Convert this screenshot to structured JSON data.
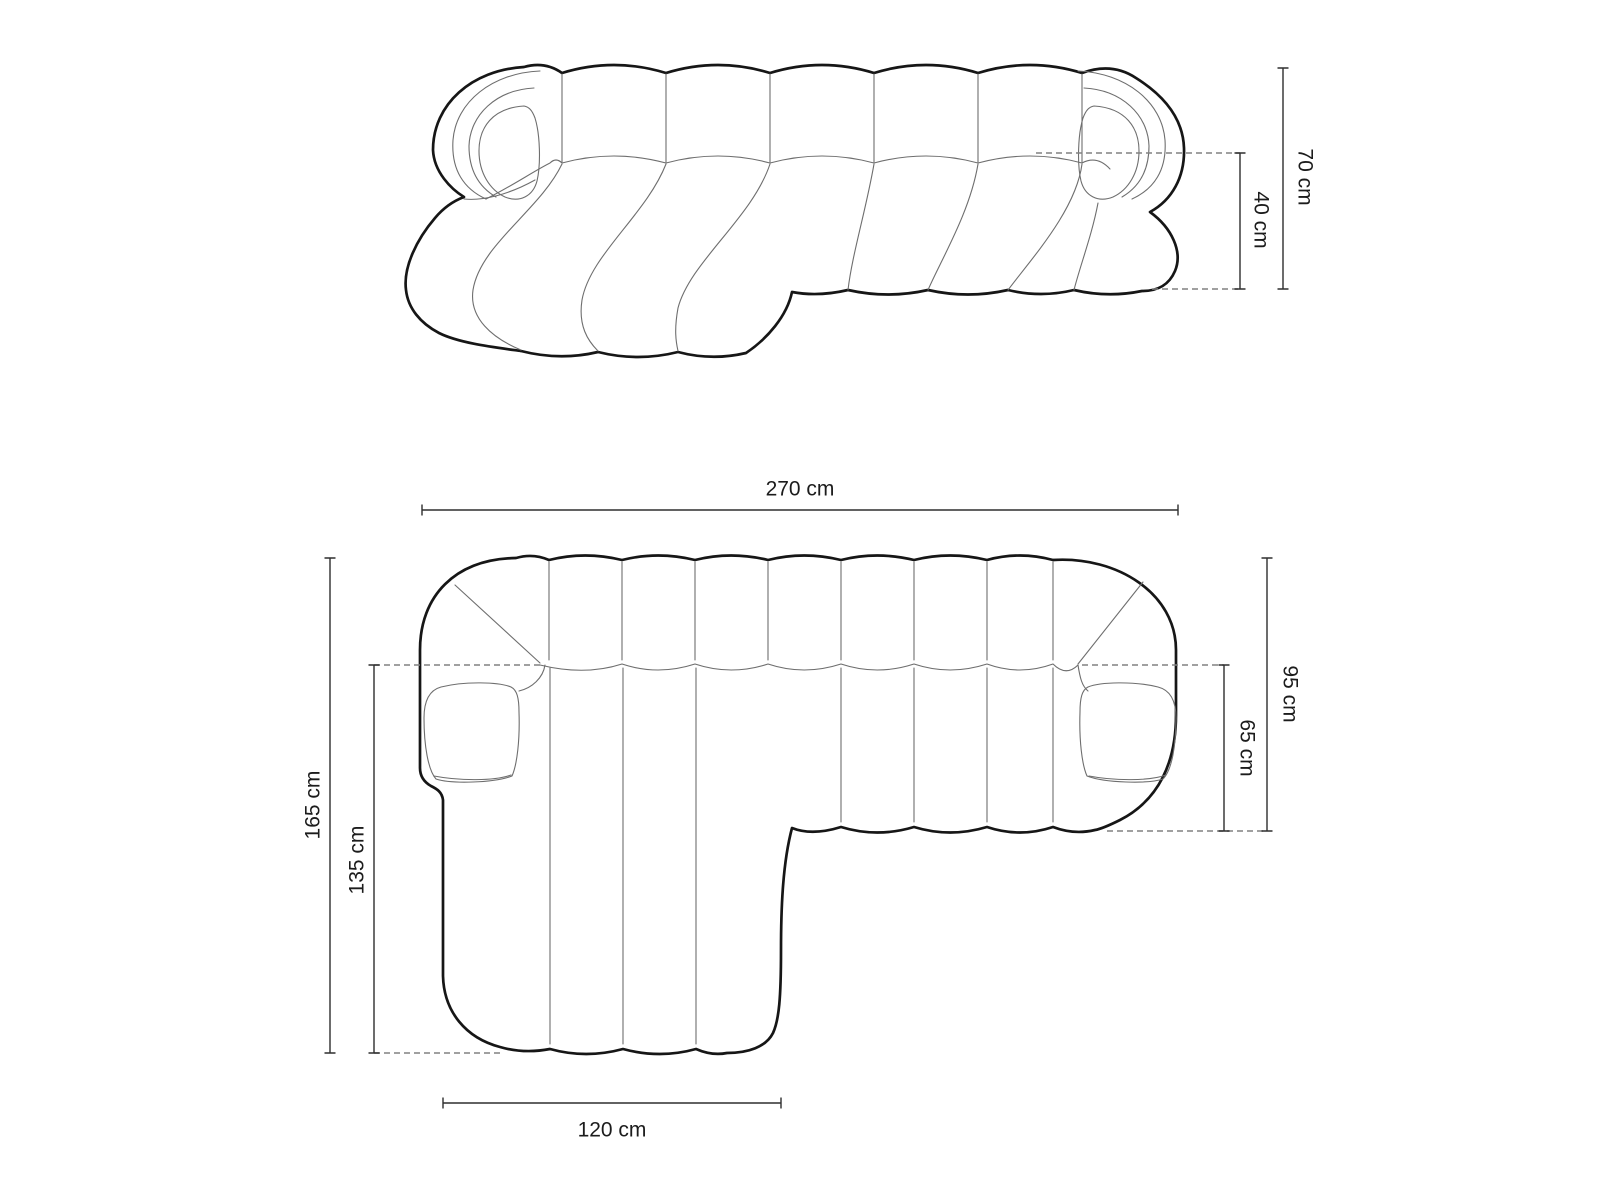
{
  "views": {
    "front": {
      "name": "sofa-front-elevation",
      "dimensions": {
        "total_height": "70 cm",
        "seat_height": "40 cm"
      }
    },
    "top": {
      "name": "sofa-top-plan",
      "dimensions": {
        "total_width": "270 cm",
        "total_depth": "165 cm",
        "chaise_depth": "135 cm",
        "body_depth": "95 cm",
        "seat_depth": "65 cm",
        "chaise_width": "120 cm"
      }
    }
  },
  "colors": {
    "background": "#ffffff",
    "outline": "#161616",
    "detail": "#6e6e6e",
    "dashed": "#808080",
    "dimension": "#2e2e2e",
    "text": "#1c1c1c"
  }
}
